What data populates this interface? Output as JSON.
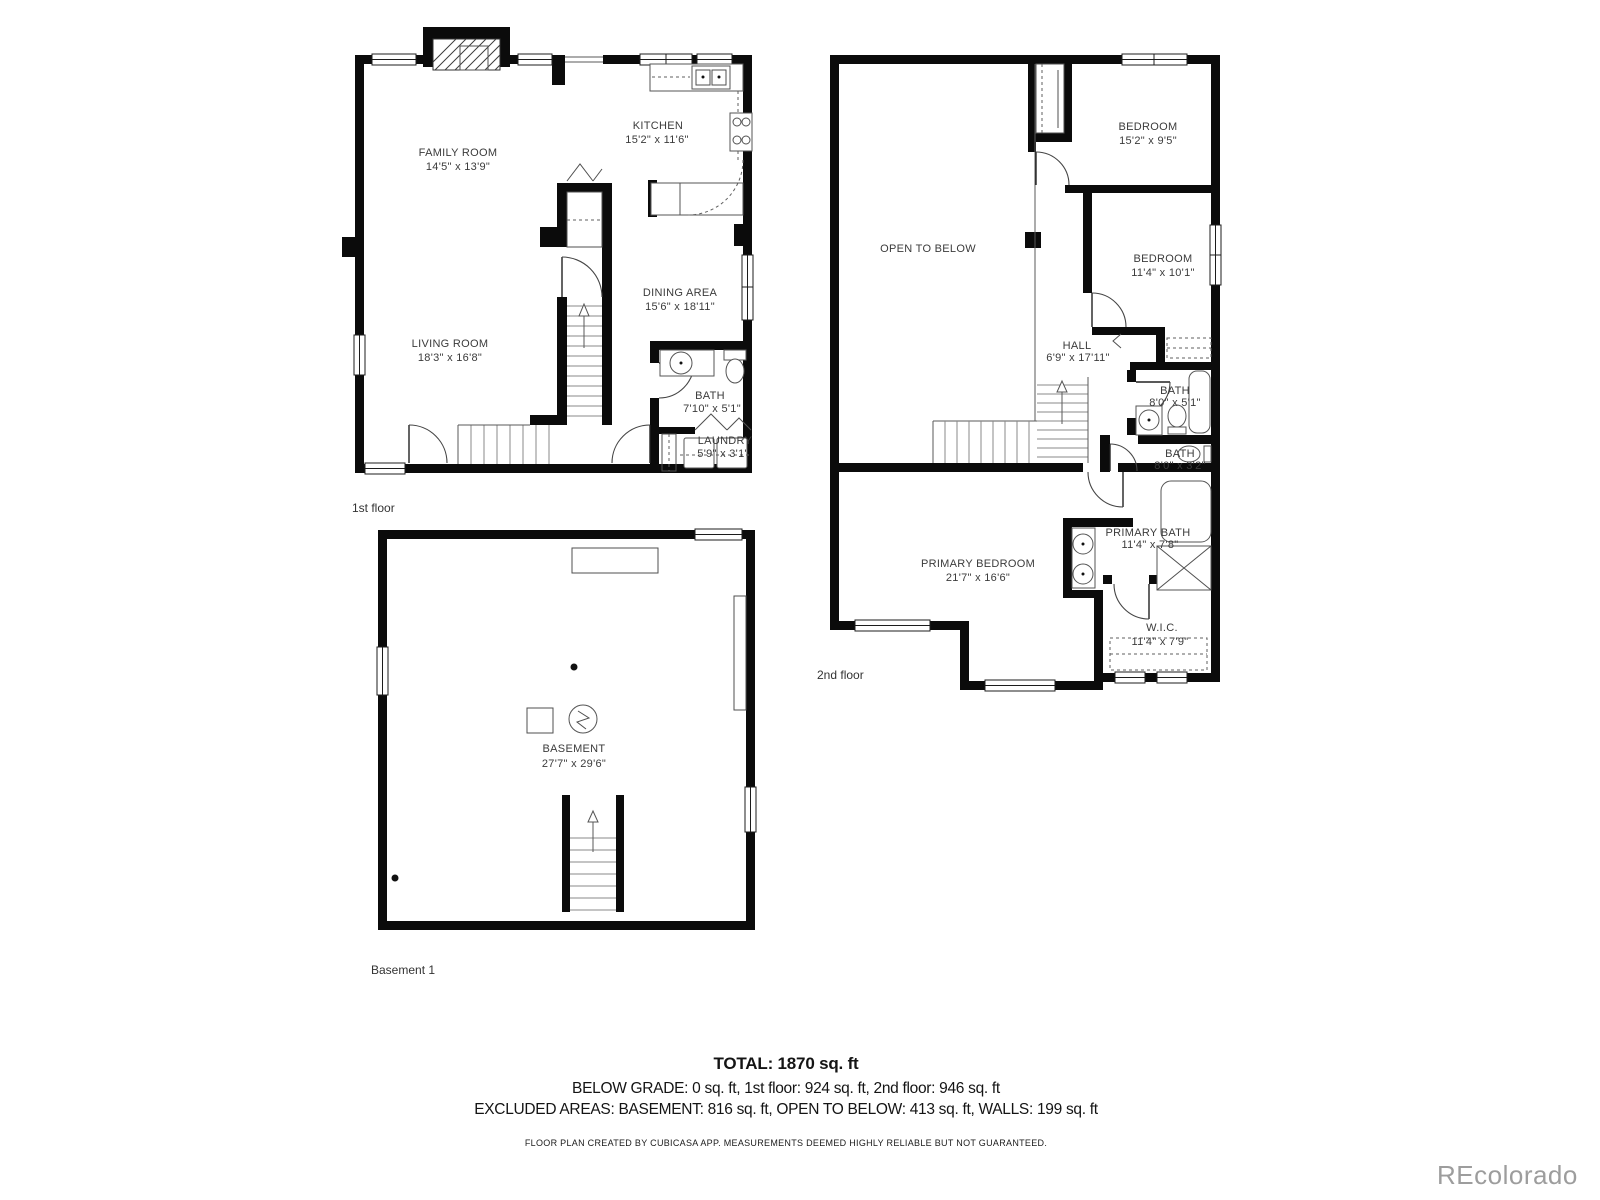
{
  "floors": [
    {
      "label": "1st floor",
      "rooms": [
        {
          "name": "FAMILY ROOM",
          "dims": "14'5\" x 13'9\""
        },
        {
          "name": "KITCHEN",
          "dims": "15'2\" x 11'6\""
        },
        {
          "name": "LIVING ROOM",
          "dims": "18'3\" x 16'8\""
        },
        {
          "name": "DINING AREA",
          "dims": "15'6\" x 18'11\""
        },
        {
          "name": "BATH",
          "dims": "7'10\" x 5'1\""
        },
        {
          "name": "LAUNDRY",
          "dims": "5'9\" x 3'1\""
        }
      ]
    },
    {
      "label": "2nd floor",
      "rooms": [
        {
          "name": "OPEN TO BELOW",
          "dims": ""
        },
        {
          "name": "BEDROOM",
          "dims": "15'2\" x 9'5\""
        },
        {
          "name": "BEDROOM",
          "dims": "11'4\" x 10'1\""
        },
        {
          "name": "HALL",
          "dims": "6'9\" x 17'11\""
        },
        {
          "name": "BATH",
          "dims": "8'0\" x 5'1\""
        },
        {
          "name": "BATH",
          "dims": "8'0\" x 3'2\""
        },
        {
          "name": "PRIMARY BEDROOM",
          "dims": "21'7\" x 16'6\""
        },
        {
          "name": "PRIMARY BATH",
          "dims": "11'4\" x 7'8\""
        },
        {
          "name": "W.I.C.",
          "dims": "11'4\" x 7'9\""
        }
      ]
    },
    {
      "label": "Basement 1",
      "rooms": [
        {
          "name": "BASEMENT",
          "dims": "27'7\" x 29'6\""
        }
      ]
    }
  ],
  "summary": {
    "total": "TOTAL: 1870 sq. ft",
    "line2": "BELOW GRADE: 0 sq. ft, 1st floor: 924 sq. ft, 2nd floor: 946 sq. ft",
    "line3": "EXCLUDED AREAS: BASEMENT: 816 sq. ft, OPEN TO BELOW: 413 sq. ft, WALLS: 199 sq. ft"
  },
  "footer": "FLOOR PLAN CREATED BY CUBICASA APP. MEASUREMENTS DEEMED HIGHLY RELIABLE BUT NOT GUARANTEED.",
  "watermark": "REcolorado",
  "colors": {
    "wall": "#0b0b0b",
    "background": "#ffffff",
    "watermark_gray": "#9d9d9d"
  }
}
